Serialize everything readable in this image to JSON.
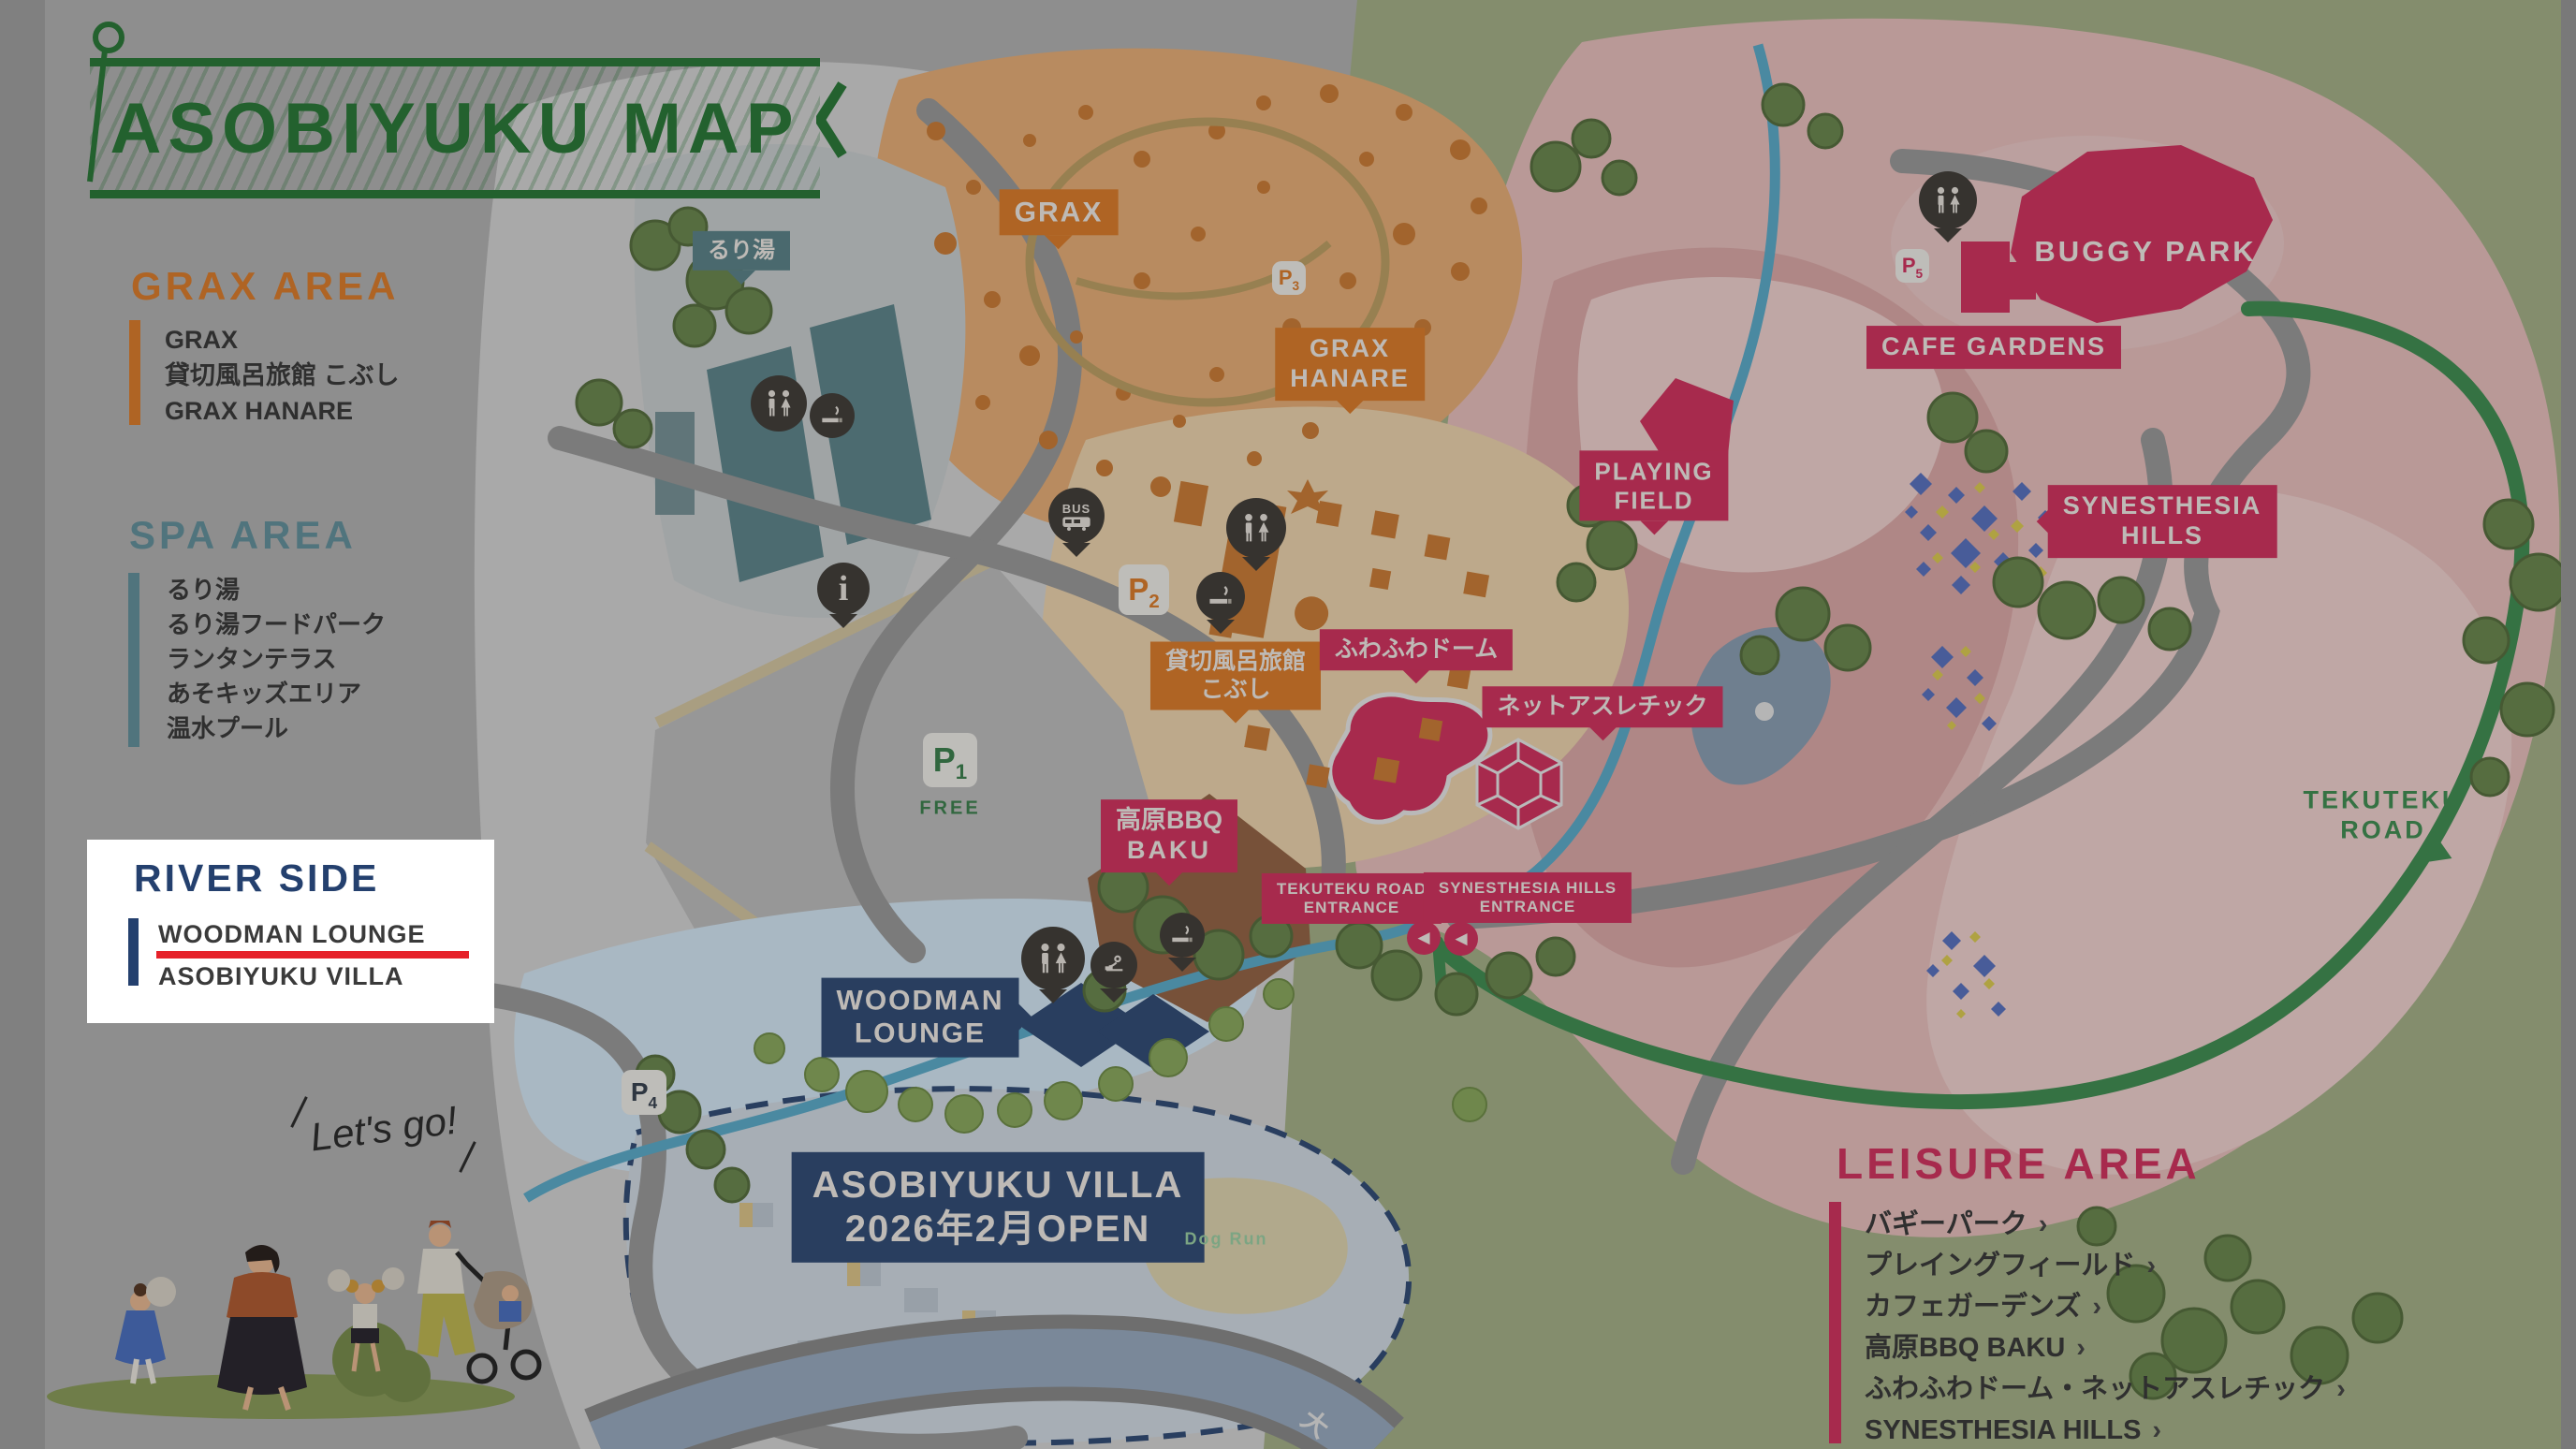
{
  "title": "ASOBIYUKU MAP",
  "legend": {
    "grax_area": {
      "heading": "GRAX AREA",
      "items": [
        "GRAX",
        "貸切風呂旅館 こぶし",
        "GRAX HANARE"
      ]
    },
    "spa_area": {
      "heading": "SPA AREA",
      "items": [
        "るり湯",
        "るり湯フードパーク",
        "ランタンテラス",
        "あそキッズエリア",
        "温水プール"
      ]
    },
    "river_side": {
      "heading": "RIVER SIDE",
      "items": [
        "WOODMAN LOUNGE",
        "ASOBIYUKU VILLA"
      ],
      "highlighted_item": "WOODMAN LOUNGE"
    },
    "leisure_area": {
      "heading": "LEISURE AREA",
      "chevron": "›",
      "items": [
        "バギーパーク",
        "プレイングフィールド",
        "カフェガーデンズ",
        "高原BBQ BAKU",
        "ふわふわドーム・ネットアスレチック",
        "SYNESTHESIA HILLS"
      ]
    }
  },
  "map_labels": {
    "ruriyu": "るり湯",
    "grax": "GRAX",
    "grax_hanare_1": "GRAX",
    "grax_hanare_2": "HANARE",
    "kashikiri_1": "貸切風呂旅館",
    "kashikiri_2": "こぶし",
    "buggy_park": "BUGGY PARK",
    "cafe_gardens": "CAFE GARDENS",
    "playing_field_1": "PLAYING",
    "playing_field_2": "FIELD",
    "synesthesia_hills_1": "SYNESTHESIA",
    "synesthesia_hills_2": "HILLS",
    "fuwafuwa_dome": "ふわふわドーム",
    "net_athletic": "ネットアスレチック",
    "bbq_1": "高原BBQ",
    "bbq_2": "BAKU",
    "tekuteku_entrance_1": "TEKUTEKU ROAD",
    "tekuteku_entrance_2": "ENTRANCE",
    "synesthesia_entrance_1": "SYNESTHESIA HILLS",
    "synesthesia_entrance_2": "ENTRANCE",
    "woodman_1": "WOODMAN",
    "woodman_2": "LOUNGE",
    "villa_1": "ASOBIYUKU VILLA",
    "villa_2": "2026年2月OPEN",
    "tekuteku_road_1": "TEKUTEKU",
    "tekuteku_road_2": "ROAD",
    "dog_run": "Dog Run",
    "lets_go": "Let's go!",
    "road_text": "大"
  },
  "parking": {
    "letter": "P",
    "p1_num": "1",
    "p1_sub": "FREE",
    "p2_num": "2",
    "p3_num": "3",
    "p4_num": "4",
    "p5_num": "5"
  },
  "glyphs": {
    "entrance_arrow": "◀",
    "info": "i",
    "bus": "BUS",
    "tekuteku_arrow": "◀"
  },
  "colors": {
    "title_green": "#2e7d3c",
    "grax_orange": "#e0812f",
    "spa_teal": "#5f878d",
    "river_navy": "#24406e",
    "leisure_crimson": "#d63763",
    "highlight_red": "#e62129",
    "sage_green": "#a9b58c",
    "pink": "#edc4c2",
    "stream_blue": "#5fb0cf"
  }
}
